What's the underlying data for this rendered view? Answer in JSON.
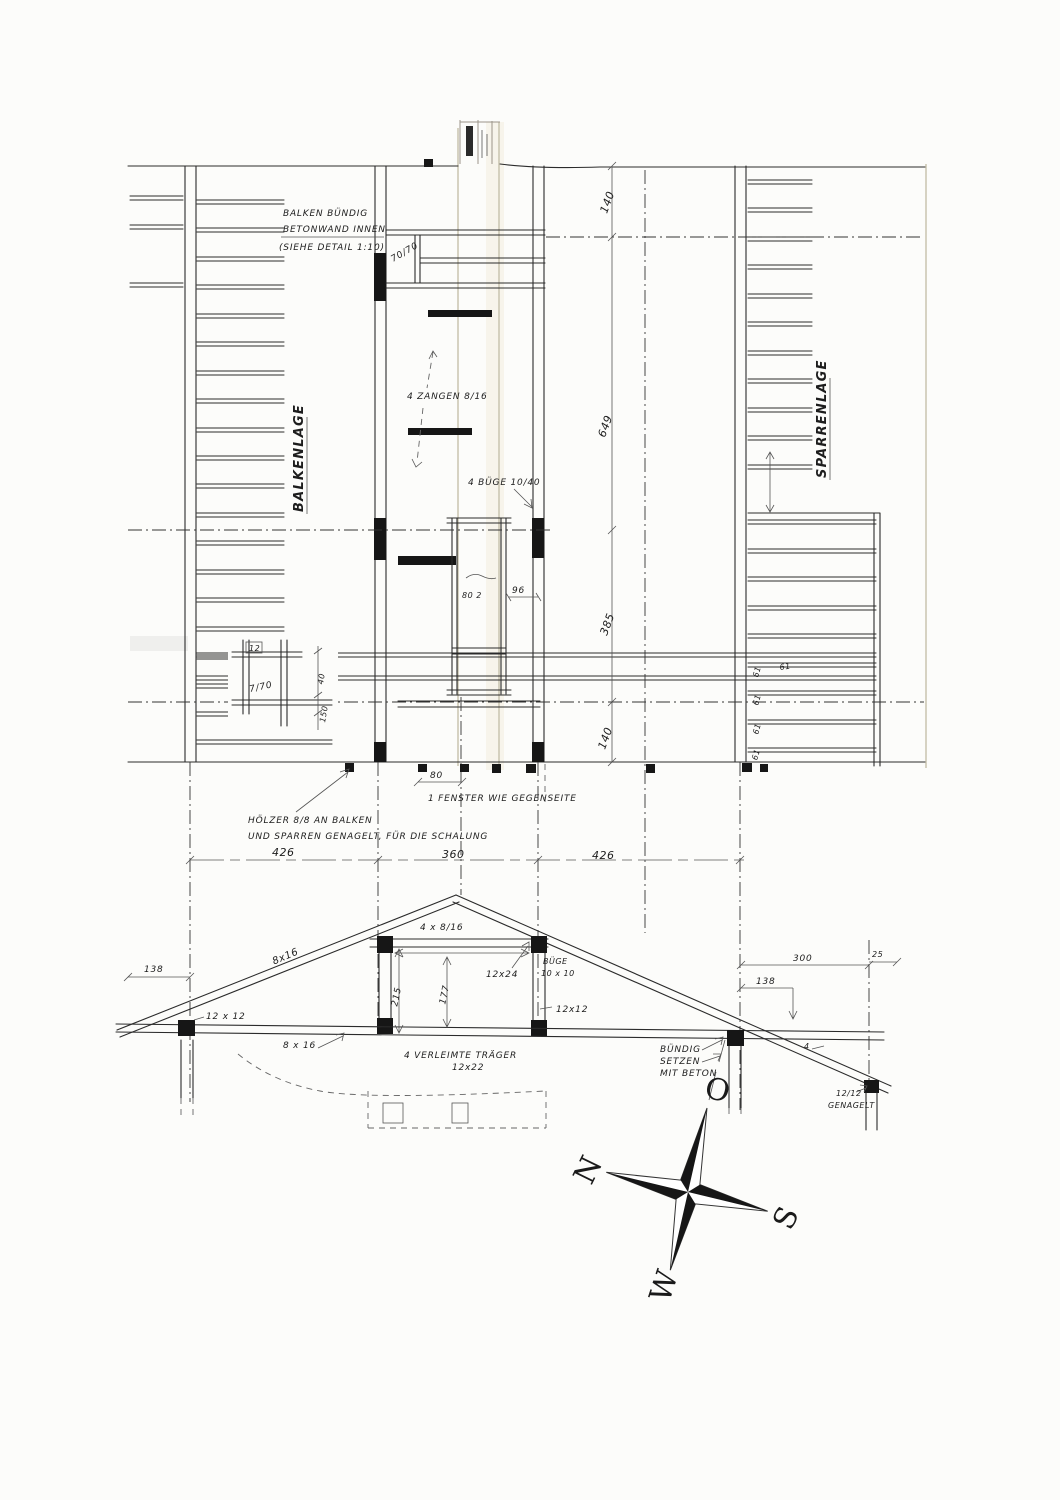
{
  "plan": {
    "balkenlage": "BALKENLAGE",
    "sparrenlage": "SPARRENLAGE",
    "note_balken_l1": "BALKEN BÜNDIG",
    "note_balken_l2": "BETONWAND INNEN",
    "note_balken_l3": "(SIEHE DETAIL 1:10)",
    "dim_70_70": "70/70",
    "note_zangen": "4 ZANGEN 8/16",
    "note_buege": "4 BÜGE 10/40",
    "dim_right_top": "140",
    "dim_right_mid": "649",
    "dim_right_lower": "385",
    "dim_right_bottom": "140",
    "dim_96": "96",
    "dim_80_2": "80 2",
    "sparren_spacing": "61",
    "detail_12": "12",
    "detail_7_70": "7/70",
    "detail_150": "150",
    "detail_40": "40",
    "dim_window_width": "80",
    "note_fenster": "1 FENSTER WIE GEGENSEITE",
    "note_hoelzer_l1": "HÖLZER 8/8 AN BALKEN",
    "note_hoelzer_l2": "UND SPARREN GENAGELT, FÜR DIE SCHALUNG",
    "dim_width_left": "426",
    "dim_width_mid": "360",
    "dim_width_right": "426"
  },
  "truss": {
    "rafter_label": "8x16",
    "collar_label": "4 x 8/16",
    "dim_215": "215",
    "dim_177": "177",
    "label_12x24": "12x24",
    "buege_l1": "BÜGE",
    "buege_l2": "10 x 10",
    "label_12x12_right": "12x12",
    "label_12x12_left": "12 x 12",
    "chord_label": "8 x 16",
    "glulam_l1": "4 VERLEIMTE TRÄGER",
    "glulam_l2": "12x22",
    "buendig_l1": "BÜNDIG",
    "buendig_l2": "SETZEN",
    "buendig_l3": "MIT BETON",
    "dim_138_left": "138",
    "dim_300": "300",
    "dim_25": "25",
    "dim_138_right": "138",
    "mark_4": "4",
    "nail_l1": "12/12",
    "nail_l2": "GENAGELT"
  },
  "compass": {
    "north": "N",
    "east": "O",
    "south": "S",
    "west": "W"
  }
}
